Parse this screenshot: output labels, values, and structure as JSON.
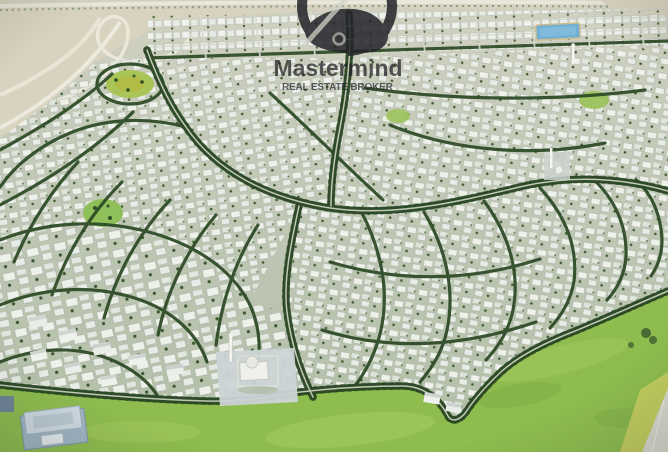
{
  "watermark": {
    "brand": "Mastermind",
    "tagline": "REAL ESTATE BROKER",
    "logo_icon": "mastermind-ring-head-icon",
    "text_color": "#1d1d20"
  },
  "palette": {
    "sand": "#d8d3bf",
    "urban_base_top": "#c9cdbd",
    "urban_base_bottom": "#b6c1ab",
    "house_white": "#eef1ec",
    "tree_green": "#2f4c28",
    "street_line": "#d3d7c7",
    "grass_field": "#8ebc4f",
    "grass_light": "#a9cd64",
    "verge_yellow": "#c3cd5f",
    "road_gray": "#d9d9d0",
    "water_blue": "#6fb0d4",
    "plaza_gray": "#ccd4d6",
    "industrial_blue": "#9fb4c4"
  },
  "scene": {
    "type": "aerial-masterplan-render",
    "features": [
      "highway-interchange",
      "apartment-band",
      "villa-districts",
      "tree-lined-boulevards",
      "circular-park",
      "community-mosque",
      "lake",
      "grass-field",
      "industrial-warehouse",
      "perimeter-road"
    ]
  }
}
